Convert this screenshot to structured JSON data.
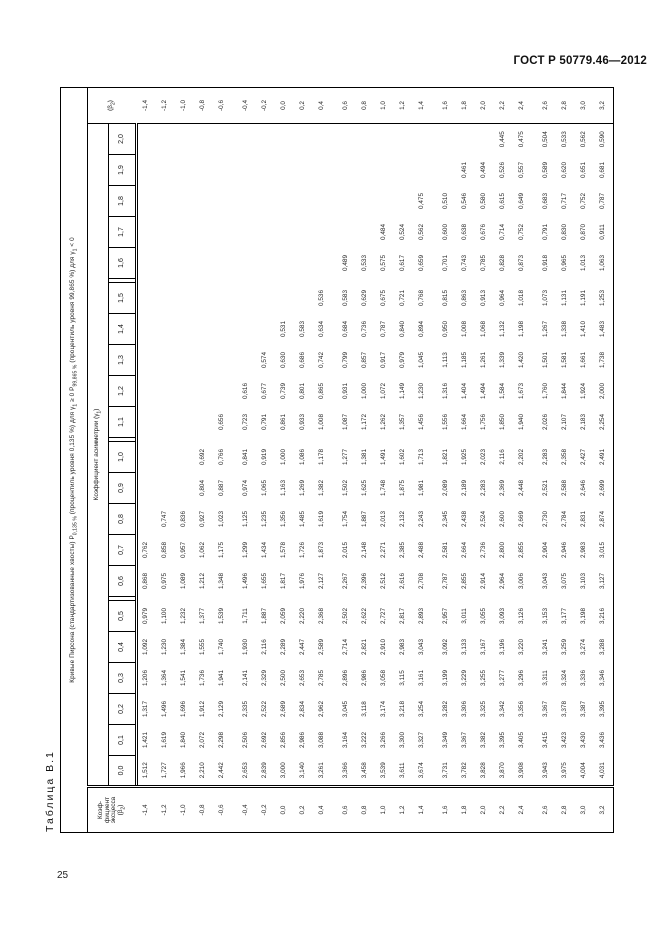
{
  "page": {
    "standard_ref": "ГОСТ Р 50779.46—2012",
    "page_number": "25"
  },
  "table": {
    "title": "Таблица В.1",
    "header": {
      "p1": "Кривые Пирсона (стандартизованные хвосты) Р",
      "s1": "0,135 %",
      "p2": " (процентиль уровня 0,135 %) для γ",
      "s2": "1",
      "p3": " ≥ 0   Р",
      "s3": "99,865 %",
      "p4": " (процентиль уровня 99,865 %) для γ",
      "s4": "1",
      "p5": " < 0"
    },
    "asymmetry_header": {
      "p1": "Коэффициент асимметрии (γ",
      "s1": "1",
      "p2": ")"
    },
    "stub": {
      "l1": "Коэф-",
      "l2": "фициент",
      "l3": "эксцесса",
      "p4": "(β",
      "s4": "2",
      "p5": ")"
    },
    "beta_repeat_header": {
      "p1": "(β",
      "s1": "2",
      "p2": ")"
    },
    "gamma_labels": [
      "0,0",
      "0,1",
      "0,2",
      "0,3",
      "0,4",
      "0,5",
      "0,6",
      "0,7",
      "0,8",
      "0,9",
      "1,0",
      "1,1",
      "1,2",
      "1,3",
      "1,4",
      "1,5",
      "1,6",
      "1,7",
      "1,8",
      "1,9",
      "2,0"
    ],
    "rows": [
      {
        "beta": "-1,4",
        "values": [
          "1,512",
          "1,421",
          "1,317",
          "1,206",
          "1,092",
          "0,979",
          "0,868",
          "0,762",
          "",
          "",
          "",
          "",
          "",
          "",
          "",
          "",
          "",
          "",
          "",
          "",
          ""
        ]
      },
      {
        "beta": "-1,2",
        "values": [
          "1,727",
          "1,619",
          "1,496",
          "1,364",
          "1,230",
          "1,100",
          "0,975",
          "0,858",
          "0,747",
          "",
          "",
          "",
          "",
          "",
          "",
          "",
          "",
          "",
          "",
          "",
          ""
        ]
      },
      {
        "beta": "-1,0",
        "values": [
          "1,966",
          "1,840",
          "1,696",
          "1,541",
          "1,384",
          "1,232",
          "1,089",
          "0,957",
          "0,836",
          "",
          "",
          "",
          "",
          "",
          "",
          "",
          "",
          "",
          "",
          "",
          ""
        ]
      },
      {
        "beta": "-0,8",
        "values": [
          "2,210",
          "2,072",
          "1,912",
          "1,736",
          "1,555",
          "1,377",
          "1,212",
          "1,062",
          "0,927",
          "0,804",
          "0,692",
          "",
          "",
          "",
          "",
          "",
          "",
          "",
          "",
          "",
          ""
        ]
      },
      {
        "beta": "-0,6",
        "values": [
          "2,442",
          "2,298",
          "2,129",
          "1,941",
          "1,740",
          "1,539",
          "1,348",
          "1,175",
          "1,023",
          "0,887",
          "0,766",
          "0,656",
          "",
          "",
          "",
          "",
          "",
          "",
          "",
          "",
          ""
        ]
      },
      {
        "beta": "-0,4",
        "values": [
          "2,653",
          "2,506",
          "2,335",
          "2,141",
          "1,930",
          "1,711",
          "1,496",
          "1,299",
          "1,125",
          "0,974",
          "0,841",
          "0,723",
          "0,616",
          "",
          "",
          "",
          "",
          "",
          "",
          "",
          ""
        ]
      },
      {
        "beta": "-0,2",
        "values": [
          "2,839",
          "2,692",
          "2,522",
          "2,329",
          "2,116",
          "1,887",
          "1,655",
          "1,434",
          "1,235",
          "1,065",
          "0,919",
          "0,791",
          "0,677",
          "0,574",
          "",
          "",
          "",
          "",
          "",
          "",
          ""
        ]
      },
      {
        "beta": "0,0",
        "values": [
          "3,000",
          "2,856",
          "2,689",
          "2,500",
          "2,289",
          "2,059",
          "1,817",
          "1,578",
          "1,356",
          "1,163",
          "1,000",
          "0,861",
          "0,739",
          "0,630",
          "0,531",
          "",
          "",
          "",
          "",
          "",
          ""
        ]
      },
      {
        "beta": "0,2",
        "values": [
          "3,140",
          "2,986",
          "2,834",
          "2,653",
          "2,447",
          "2,220",
          "1,976",
          "1,726",
          "1,485",
          "1,269",
          "1,086",
          "0,933",
          "0,801",
          "0,686",
          "0,583",
          "",
          "",
          "",
          "",
          "",
          ""
        ]
      },
      {
        "beta": "0,4",
        "values": [
          "3,261",
          "3,088",
          "2,962",
          "2,785",
          "2,589",
          "2,368",
          "2,127",
          "1,873",
          "1,619",
          "1,382",
          "1,178",
          "1,008",
          "0,865",
          "0,742",
          "0,634",
          "0,536",
          "",
          "",
          "",
          "",
          ""
        ]
      },
      {
        "beta": "0,6",
        "values": [
          "3,366",
          "3,164",
          "3,045",
          "2,896",
          "2,714",
          "2,502",
          "2,267",
          "2,015",
          "1,754",
          "1,502",
          "1,277",
          "1,087",
          "0,931",
          "0,799",
          "0,684",
          "0,583",
          "0,489",
          "",
          "",
          "",
          ""
        ]
      },
      {
        "beta": "0,8",
        "values": [
          "3,458",
          "3,222",
          "3,118",
          "2,986",
          "2,821",
          "2,622",
          "2,396",
          "2,148",
          "1,887",
          "1,625",
          "1,381",
          "1,172",
          "1,000",
          "0,857",
          "0,736",
          "0,629",
          "0,533",
          "",
          "",
          "",
          ""
        ]
      },
      {
        "beta": "1,0",
        "values": [
          "3,539",
          "3,266",
          "3,174",
          "3,058",
          "2,910",
          "2,727",
          "2,512",
          "2,271",
          "2,013",
          "1,748",
          "1,491",
          "1,262",
          "1,072",
          "0,917",
          "0,787",
          "0,675",
          "0,575",
          "0,484",
          "",
          "",
          ""
        ]
      },
      {
        "beta": "1,2",
        "values": [
          "3,611",
          "3,300",
          "3,218",
          "3,115",
          "2,983",
          "2,817",
          "2,616",
          "2,385",
          "2,132",
          "1,875",
          "1,602",
          "1,357",
          "1,149",
          "0,979",
          "0,840",
          "0,721",
          "0,617",
          "0,524",
          "",
          "",
          ""
        ]
      },
      {
        "beta": "1,4",
        "values": [
          "3,674",
          "3,327",
          "3,254",
          "3,161",
          "3,043",
          "2,893",
          "2,708",
          "2,488",
          "2,243",
          "1,981",
          "1,713",
          "1,456",
          "1,230",
          "1,045",
          "0,894",
          "0,768",
          "0,659",
          "0,562",
          "0,475",
          "",
          ""
        ]
      },
      {
        "beta": "1,6",
        "values": [
          "3,731",
          "3,349",
          "3,282",
          "3,199",
          "3,092",
          "2,957",
          "2,787",
          "2,581",
          "2,345",
          "2,089",
          "1,821",
          "1,556",
          "1,316",
          "1,113",
          "0,950",
          "0,815",
          "0,701",
          "0,600",
          "0,510",
          "",
          ""
        ]
      },
      {
        "beta": "1,8",
        "values": [
          "3,782",
          "3,367",
          "3,306",
          "3,229",
          "3,133",
          "3,011",
          "2,855",
          "2,664",
          "2,438",
          "2,189",
          "1,925",
          "1,664",
          "1,404",
          "1,185",
          "1,008",
          "0,863",
          "0,743",
          "0,638",
          "0,546",
          "0,461",
          ""
        ]
      },
      {
        "beta": "2,0",
        "values": [
          "3,828",
          "3,382",
          "3,325",
          "3,255",
          "3,167",
          "3,055",
          "2,914",
          "2,736",
          "2,524",
          "2,283",
          "2,023",
          "1,756",
          "1,494",
          "1,261",
          "1,068",
          "0,913",
          "0,785",
          "0,676",
          "0,580",
          "0,494",
          ""
        ]
      },
      {
        "beta": "2,2",
        "values": [
          "3,870",
          "3,395",
          "3,342",
          "3,277",
          "3,196",
          "3,093",
          "2,964",
          "2,800",
          "2,600",
          "2,369",
          "2,116",
          "1,850",
          "1,584",
          "1,339",
          "1,132",
          "0,964",
          "0,828",
          "0,714",
          "0,615",
          "0,526",
          "0,445"
        ]
      },
      {
        "beta": "2,4",
        "values": [
          "3,908",
          "3,405",
          "3,356",
          "3,296",
          "3,220",
          "3,126",
          "3,006",
          "2,855",
          "2,669",
          "2,448",
          "2,202",
          "1,940",
          "1,673",
          "1,420",
          "1,198",
          "1,018",
          "0,873",
          "0,752",
          "0,649",
          "0,557",
          "0,475"
        ]
      },
      {
        "beta": "2,6",
        "values": [
          "3,943",
          "3,415",
          "3,367",
          "3,311",
          "3,241",
          "3,153",
          "3,043",
          "2,904",
          "2,730",
          "2,521",
          "2,283",
          "2,026",
          "1,760",
          "1,501",
          "1,267",
          "1,073",
          "0,918",
          "0,791",
          "0,683",
          "0,589",
          "0,504"
        ]
      },
      {
        "beta": "2,8",
        "values": [
          "3,975",
          "3,423",
          "3,378",
          "3,324",
          "3,259",
          "3,177",
          "3,075",
          "2,946",
          "2,784",
          "2,588",
          "2,358",
          "2,107",
          "1,844",
          "1,581",
          "1,338",
          "1,131",
          "0,965",
          "0,830",
          "0,717",
          "0,620",
          "0,533"
        ]
      },
      {
        "beta": "3,0",
        "values": [
          "4,004",
          "3,430",
          "3,387",
          "3,336",
          "3,274",
          "3,198",
          "3,103",
          "2,983",
          "2,831",
          "2,646",
          "2,427",
          "2,183",
          "1,924",
          "1,661",
          "1,410",
          "1,191",
          "1,013",
          "0,870",
          "0,752",
          "0,651",
          "0,562"
        ]
      },
      {
        "beta": "3,2",
        "values": [
          "4,031",
          "3,436",
          "3,395",
          "3,346",
          "3,288",
          "3,216",
          "3,127",
          "3,015",
          "2,874",
          "2,699",
          "2,491",
          "2,254",
          "2,000",
          "1,738",
          "1,483",
          "1,253",
          "1,063",
          "0,911",
          "0,787",
          "0,681",
          "0,590"
        ]
      }
    ]
  }
}
